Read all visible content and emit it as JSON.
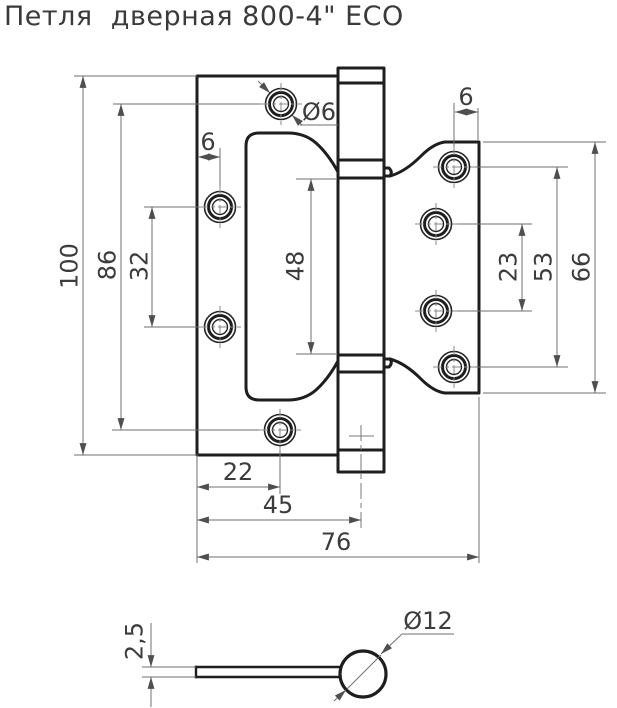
{
  "title": "Петля  дверная 800-4\" ECO",
  "front_view": {
    "dimensions": {
      "total_height": "100",
      "hole_span_vertical": "86",
      "left_holes_spacing": "32",
      "left_edge_offset": "6",
      "screw_hole_diameter": "Ø6",
      "cutout_height": "48",
      "right_edge_offset": "6",
      "right_holes_inner_spacing": "23",
      "right_holes_outer_spacing": "53",
      "right_plate_height": "66",
      "bottom_hole_offset": "22",
      "pin_axis_offset": "45",
      "total_width": "76"
    }
  },
  "side_view": {
    "dimensions": {
      "plate_thickness": "2,5",
      "barrel_diameter": "Ø12"
    }
  }
}
